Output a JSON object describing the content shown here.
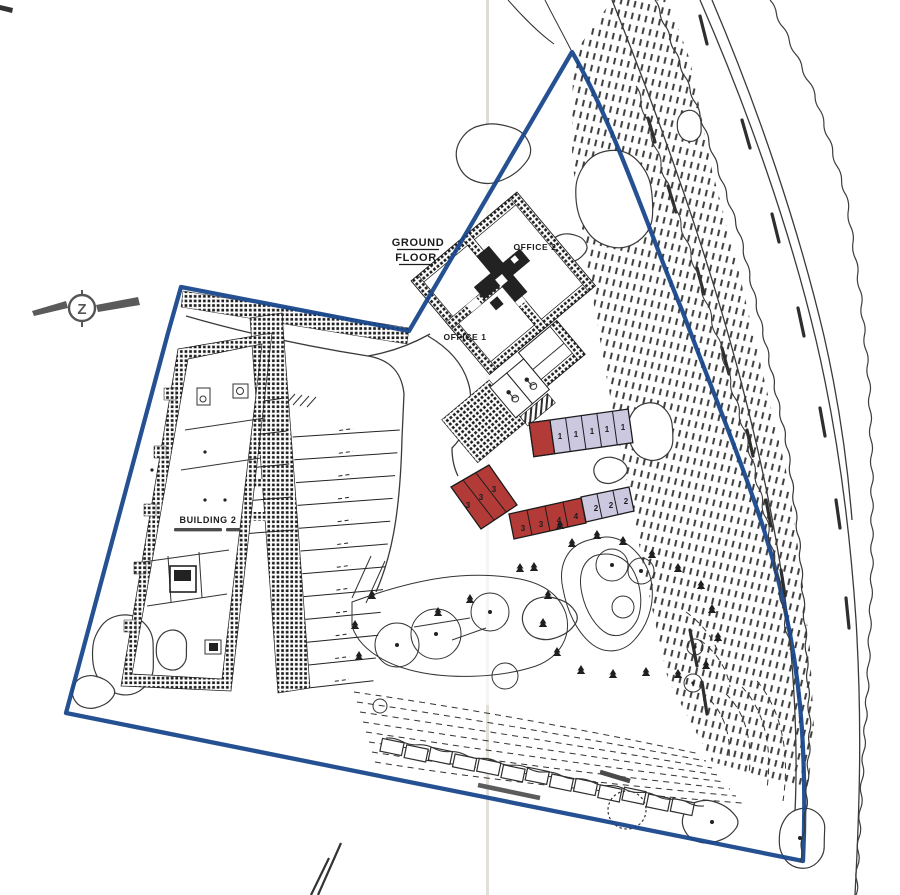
{
  "labels": {
    "ground_floor_line1": "GROUND",
    "ground_floor_line2": "FLOOR",
    "office1": "OFFICE 1",
    "office2": "OFFICE 2",
    "building2": "BUILDING 2"
  },
  "compass": {
    "letter": "Z"
  },
  "units": {
    "row_top": [
      "1",
      "1",
      "1",
      "1",
      "1"
    ],
    "row_left": [
      "3",
      "3",
      "3"
    ],
    "row_mid": [
      "3",
      "3",
      "4",
      "4"
    ],
    "row_right": [
      "2",
      "2",
      "2"
    ]
  },
  "colors": {
    "boundary": "#17468c",
    "unit_red": "#b23b38",
    "unit_lavender": "#cbc8e0",
    "ink": "#2b2b2b",
    "paper": "#ffffff"
  }
}
